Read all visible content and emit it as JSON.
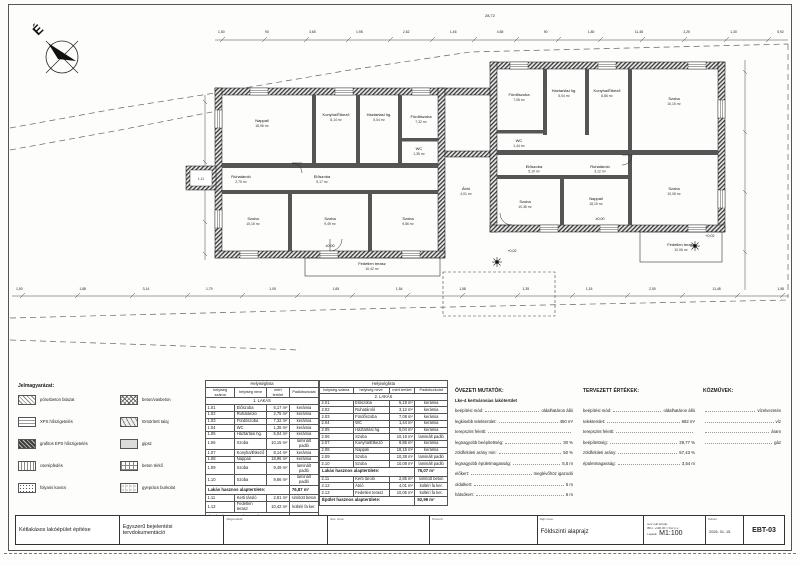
{
  "sheet": {
    "compass_label": "É"
  },
  "plan": {
    "overall_dim": "28,72",
    "top_dims": [
      "1,50",
      "90",
      "3,65",
      "1,98",
      "2,62",
      "1,46",
      "4,65",
      "90",
      "1,80",
      "11,48",
      "2,25",
      "1,30",
      "5,92"
    ],
    "bottom_dims": [
      "1,50",
      "1,88",
      "3,14",
      "1,79",
      "1,05",
      "1,65",
      "1,54",
      "1,58",
      "1,35",
      "1,15",
      "2,50",
      "11,48",
      "1,58"
    ],
    "levels": {
      "ground1": "±0,00",
      "ground2": "±0,00",
      "yard1": "+0,02",
      "yard2": "+0,02"
    }
  },
  "legend": {
    "title": "Jelmagyarázat:",
    "items_left": [
      {
        "pattern": "hatch",
        "label": "pórusbeton falazat"
      },
      {
        "pattern": "dash",
        "label": "XPS hőszigetelés"
      },
      {
        "pattern": "dark",
        "label": "grafitos EPS hőszigetelés"
      },
      {
        "pattern": "vert",
        "label": "cserépfedés"
      },
      {
        "pattern": "dots",
        "label": "folyami kavics"
      }
    ],
    "items_right": [
      {
        "pattern": "cross",
        "label": "beton/vasbeton"
      },
      {
        "pattern": "tri",
        "label": "tömörített talaj"
      },
      {
        "pattern": "solid",
        "label": "gipsz"
      },
      {
        "pattern": "grid",
        "label": "beton térkő"
      },
      {
        "pattern": "griddots",
        "label": "gyeprács burkolat"
      }
    ]
  },
  "tables": {
    "header": {
      "list_title": "Helyiséglista",
      "col_num": "helyiség száma",
      "col_name": "helyiség neve",
      "col_area": "mért terület",
      "col_floor": "Padlóburkolat"
    },
    "apartment1": {
      "section": "1. LAKÁS",
      "rows": [
        {
          "num": "1.01",
          "name": "Előszoba",
          "area": "5,17 m²",
          "floor": "kerámia"
        },
        {
          "num": "1.02",
          "name": "Ruhatároló",
          "area": "2,75 m²",
          "floor": "kerámia"
        },
        {
          "num": "1.03",
          "name": "Fürdőszoba",
          "area": "7,32 m²",
          "floor": "kerámia"
        },
        {
          "num": "1.04",
          "name": "WC",
          "area": "1,35 m²",
          "floor": "kerámia"
        },
        {
          "num": "1.05",
          "name": "Háztartási hg.",
          "area": "5,04 m²",
          "floor": "kerámia"
        },
        {
          "num": "1.06",
          "name": "Szoba",
          "area": "10,15 m²",
          "floor": "laminált padló"
        },
        {
          "num": "1.07",
          "name": "Konyha/Étkező",
          "area": "8,14 m²",
          "floor": "kerámia"
        },
        {
          "num": "1.08",
          "name": "Nappali",
          "area": "18,96 m²",
          "floor": "kerámia"
        },
        {
          "num": "1.09",
          "name": "Szoba",
          "area": "9,49 m²",
          "floor": "laminált padló"
        },
        {
          "num": "1.10",
          "name": "Szoba",
          "area": "9,86 m²",
          "floor": "laminált padló"
        }
      ],
      "summary_label": "Lakás hasznos alapterülete:",
      "summary_value": "76,87 m²",
      "extra_rows": [
        {
          "num": "1.11",
          "name": "Kerti tároló",
          "area": "2,81 m²",
          "floor": "simított beton"
        },
        {
          "num": "1.12",
          "name": "Fedetlen terasz",
          "area": "10,42 m²",
          "floor": "kültéri fa ker."
        }
      ],
      "footer_label": "Épület hasznos alapterülete:",
      "footer_value": "90,10 m²"
    },
    "apartment2": {
      "section": "2. LAKÁS",
      "rows": [
        {
          "num": "2.01",
          "name": "Előszoba",
          "area": "5,19 m²",
          "floor": "kerámia"
        },
        {
          "num": "2.02",
          "name": "Ruhatároló",
          "area": "3,12 m²",
          "floor": "kerámia"
        },
        {
          "num": "2.03",
          "name": "Fürdőszoba",
          "area": "7,08 m²",
          "floor": "kerámia"
        },
        {
          "num": "2.04",
          "name": "WC",
          "area": "1,44 m²",
          "floor": "kerámia"
        },
        {
          "num": "2.05",
          "name": "Háztartási hg.",
          "area": "5,04 m²",
          "floor": "kerámia"
        },
        {
          "num": "2.06",
          "name": "Szoba",
          "area": "10,15 m²",
          "floor": "laminált padló"
        },
        {
          "num": "2.07",
          "name": "Konyha/Étkező",
          "area": "8,86 m²",
          "floor": "kerámia"
        },
        {
          "num": "2.08",
          "name": "Nappali",
          "area": "18,15 m²",
          "floor": "kerámia"
        },
        {
          "num": "2.09",
          "name": "Szoba",
          "area": "10,38 m²",
          "floor": "laminált padló"
        },
        {
          "num": "2.10",
          "name": "Szoba",
          "area": "10,08 m²",
          "floor": "laminált padló"
        }
      ],
      "summary_label": "Lakás hasznos alapterülete:",
      "summary_value": "76,07 m²",
      "extra_rows": [
        {
          "num": "2.11",
          "name": "Kerti tároló",
          "area": "2,85 m²",
          "floor": "simított beton"
        },
        {
          "num": "2.12",
          "name": "Átrió",
          "area": "4,01 m²",
          "floor": "kültéri fa ker."
        },
        {
          "num": "2.13",
          "name": "Fedetlen terasz",
          "area": "10,06 m²",
          "floor": "kültéri fa ker."
        }
      ],
      "footer_label": "Épület hasznos alapterülete:",
      "footer_value": "92,99 m²"
    }
  },
  "zoning": {
    "title": "ÖVEZETI MUTATÓK:",
    "subtitle": "Lke-4 kertvárosias lakóterület",
    "rows": [
      {
        "label": "beépítési mód:",
        "value": "oldalhatáron álló"
      },
      {
        "label": "legkisebb telekterület:",
        "value": "450 m²"
      },
      {
        "label": "terepszint feletti:",
        "value": ""
      },
      {
        "label": "legnagyobb beépítettség:",
        "value": "30 %"
      },
      {
        "label": "zöldfelületi arány min:",
        "value": "50 %"
      },
      {
        "label": "legnagyobb épületmagasság:",
        "value": "5,5 m"
      },
      {
        "label": "előkert:",
        "value": "meglévőhöz igazodó"
      },
      {
        "label": "oldalkert:",
        "value": "5 m"
      },
      {
        "label": "hátsókert:",
        "value": "6 m"
      }
    ]
  },
  "planned": {
    "title": "TERVEZETT ÉRTÉKEK:",
    "rows": [
      {
        "label": "beépítési mód:",
        "value": "oldalhatáron álló"
      },
      {
        "label": "telekterület:",
        "value": "682 m²"
      },
      {
        "label": "terepszint feletti:",
        "value": ""
      },
      {
        "label": "beépítettség:",
        "value": "29,77 %"
      },
      {
        "label": "zöldfelületi arány:",
        "value": "57,43 %"
      },
      {
        "label": "épületmagasság:",
        "value": "3,54 m"
      }
    ]
  },
  "utilities": {
    "title": "KÖZMŰVEK:",
    "rows": [
      {
        "label": "",
        "value": "vízelvezetés"
      },
      {
        "label": "",
        "value": "víz"
      },
      {
        "label": "",
        "value": "áram"
      },
      {
        "label": "",
        "value": "gáz"
      }
    ]
  },
  "titleblock": {
    "project_title": "Kétlakásos lakóépület építése",
    "doc_type_line1": "Egyszerű bejelentési",
    "doc_type_line2": "tervdokumentáció",
    "client_label": "Megrendelő:",
    "client_name_label": "Név, címe:",
    "designer_label": "Tervező:",
    "drawing_label": "Rajz neve:",
    "drawing_name": "Földszinti alaprajz",
    "level_label": "terv null szintje:",
    "level_value": "Bfm: +130,00 = Fsz p.v.",
    "scale_label": "Lépték:",
    "scale_value": "M1:100",
    "date_label": "Dátum:",
    "date_value": "2026. 01. 15.",
    "sheet_number": "EBT-03"
  }
}
